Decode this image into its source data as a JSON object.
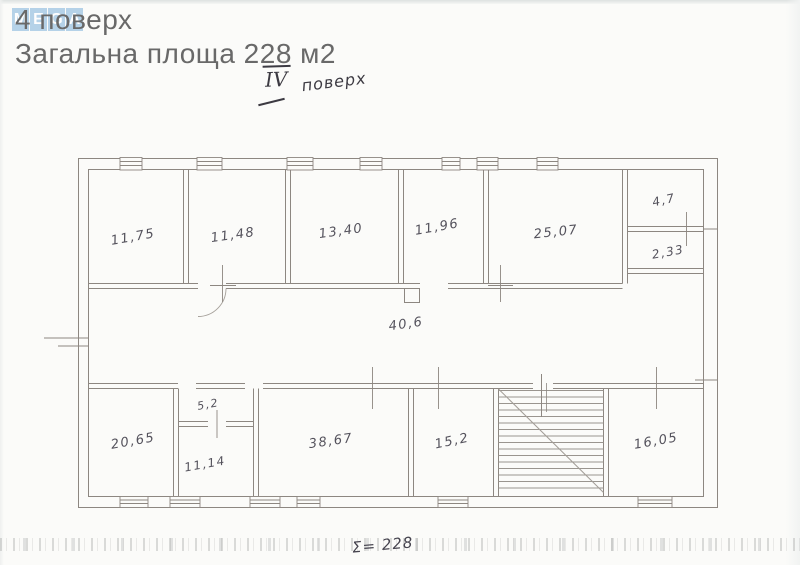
{
  "header": {
    "logo_letters": [
      "M",
      "E",
      "G",
      "A"
    ],
    "floor_title": "4 поверх",
    "area_title": "Загальна площа 228 м2"
  },
  "annotations": {
    "floor_note_numeral": "IV",
    "floor_note_word": "поверх",
    "sum_note": "Σ= 228"
  },
  "plan": {
    "type": "apartment-floor-plan",
    "total_area_m2": "228",
    "rooms": [
      {
        "id": "top-1",
        "area": "11,75"
      },
      {
        "id": "top-2",
        "area": "11,48"
      },
      {
        "id": "top-3",
        "area": "13,40"
      },
      {
        "id": "top-4",
        "area": "11,96"
      },
      {
        "id": "top-5",
        "area": "25,07"
      },
      {
        "id": "right-1",
        "area": "4,7"
      },
      {
        "id": "right-2",
        "area": "2,33"
      },
      {
        "id": "corridor",
        "area": "40,6"
      },
      {
        "id": "bottom-1",
        "area": "20,65"
      },
      {
        "id": "bottom-2",
        "area": "5,2"
      },
      {
        "id": "bottom-3",
        "area": "11,14"
      },
      {
        "id": "bottom-4",
        "area": "38,67"
      },
      {
        "id": "bottom-5",
        "area": "15,2"
      },
      {
        "id": "bottom-6",
        "area": "16,05"
      }
    ]
  },
  "colors": {
    "logo_tile": "#a9cce6",
    "header_text": "#696969",
    "wall_line": "#8d8781",
    "pencil_label": "#54525c",
    "pen_ink": "#3c3a42",
    "paper": "#fbfbf9"
  }
}
